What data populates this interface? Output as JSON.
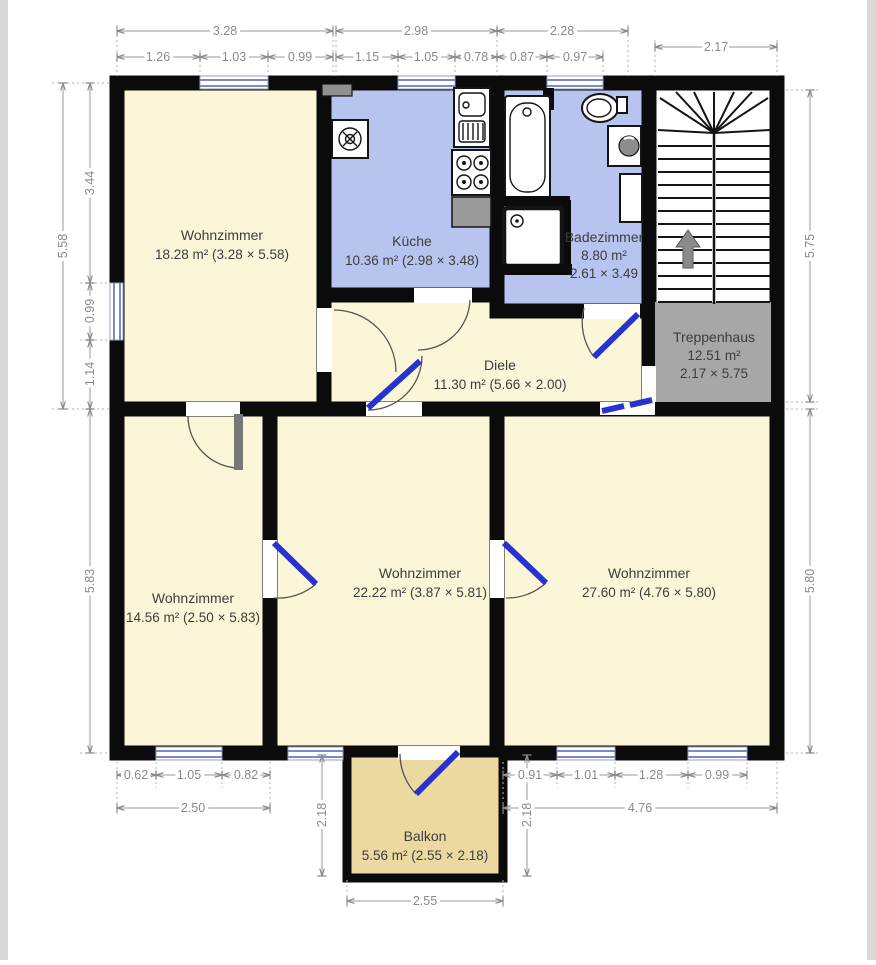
{
  "colors": {
    "wall": "#0b0b0b",
    "living": "#faf6d7",
    "wet": "#b7c4ef",
    "stair_room": "#a7a7a7",
    "stair_floor": "#ffffff",
    "balcony": "#ecd9a2",
    "door": "#2633cf",
    "window": "#7d89c9",
    "dim": "#8a8a8a",
    "label": "#3d3d3d"
  },
  "rooms": {
    "wohnzimmer_tl": {
      "name": "Wohnzimmer",
      "area": "18.28 m² (3.28 × 5.58)"
    },
    "kueche": {
      "name": "Küche",
      "area": "10.36 m² (2.98 × 3.48)"
    },
    "badezimmer": {
      "name": "Badezimmer",
      "area": "8.80 m²",
      "size": "2.61 × 3.49"
    },
    "treppenhaus": {
      "name": "Treppenhaus",
      "area": "12.51 m²",
      "size": "2.17 × 5.75"
    },
    "diele": {
      "name": "Diele",
      "area": "11.30 m² (5.66 × 2.00)"
    },
    "wohnzimmer_bl": {
      "name": "Wohnzimmer",
      "area": "14.56 m² (2.50 × 5.83)"
    },
    "wohnzimmer_bm": {
      "name": "Wohnzimmer",
      "area": "22.22 m² (3.87 × 5.81)"
    },
    "wohnzimmer_br": {
      "name": "Wohnzimmer",
      "area": "27.60 m² (4.76 × 5.80)"
    },
    "balkon": {
      "name": "Balkon",
      "area": "5.56 m² (2.55 × 2.18)"
    }
  },
  "dims": {
    "top_total": [
      "3.28",
      "2.98",
      "2.28"
    ],
    "top_stair": "2.17",
    "top_sub": [
      "1.26",
      "1.03",
      "0.99",
      "1.15",
      "1.05",
      "0.78",
      "0.87",
      "0.97"
    ],
    "left_total": "5.58",
    "left_sub": [
      "3.44",
      "0.99",
      "1.14"
    ],
    "left_bottom": "5.83",
    "right_top": "5.75",
    "right_bottom": "5.80",
    "bottom_sub_left": [
      "0.62",
      "1.05",
      "0.82"
    ],
    "bottom_total_left": "2.50",
    "bottom_sub_right": [
      "0.91",
      "1.01",
      "1.28",
      "0.99"
    ],
    "bottom_total_right": "4.76",
    "balcony_width": "2.55",
    "balcony_depth_left": "2.18",
    "balcony_depth_right": "2.18"
  }
}
